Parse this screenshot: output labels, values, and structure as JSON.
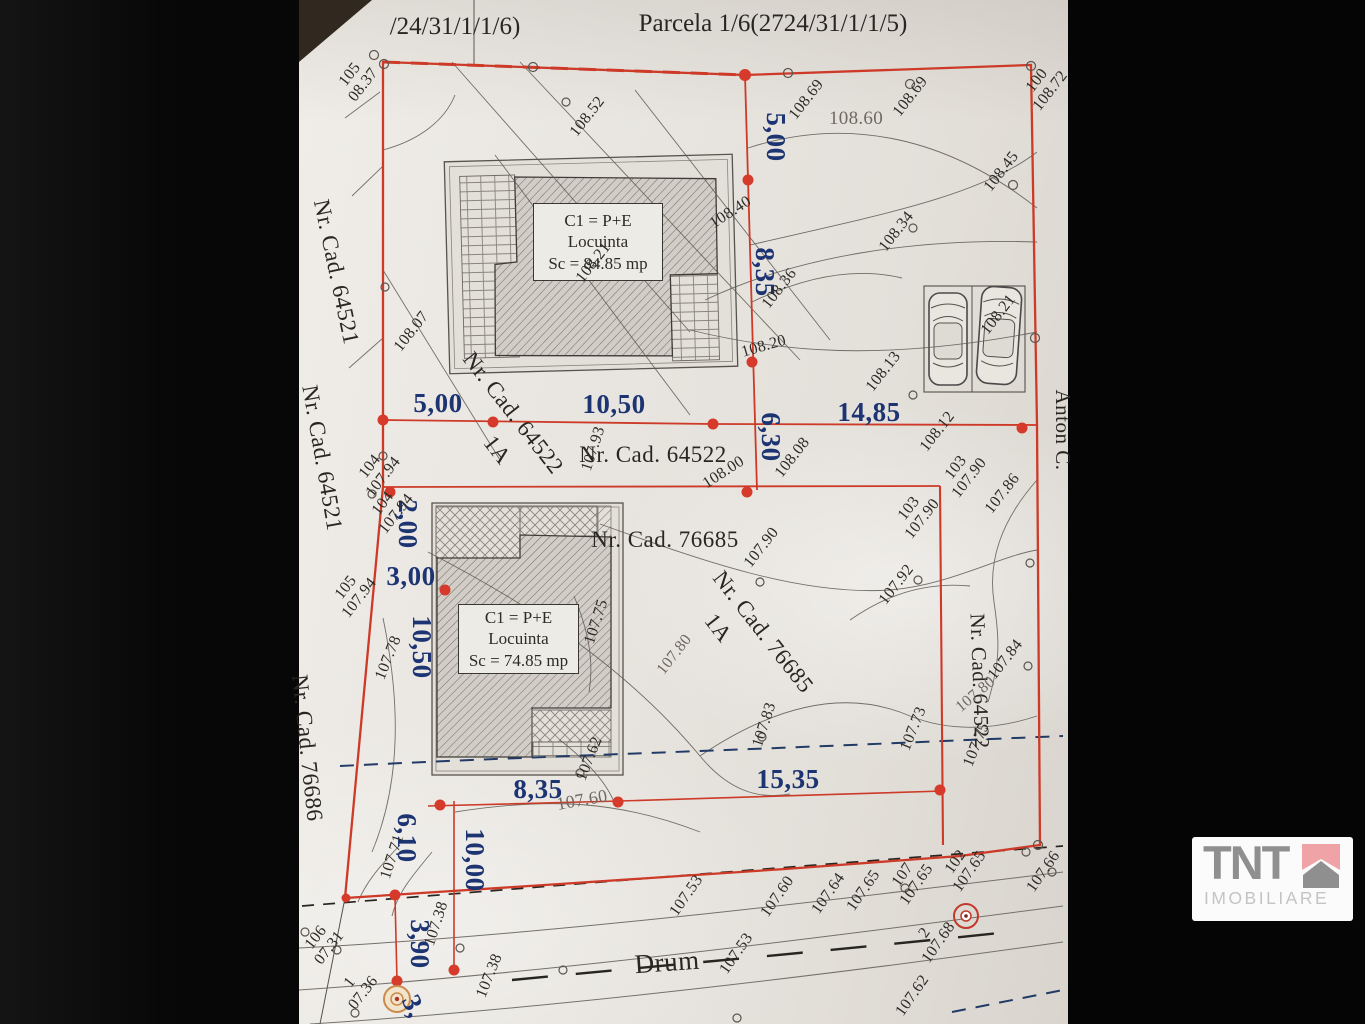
{
  "labels": {
    "header_left": "/24/31/1/1/6)",
    "header_right": "Parcela 1/6(2724/31/1/1/5)",
    "cadastral": [
      "Nr. Cad. 64521",
      "Nr. Cad. 64521",
      "Nr. Cad. 76686",
      "Nr. Cad. 64522",
      "1A",
      "Nr. Cad. 64522",
      "Nr. Cad. 76685",
      "Nr. Cad. 76685",
      "1A",
      "Nr. Cad. 64522",
      "Anton C.",
      "Drum"
    ]
  },
  "dims": [
    "5,00",
    "8,35",
    "6,30",
    "5,00",
    "10,50",
    "14,85",
    "2,00",
    "3,00",
    "10,50",
    "8,35",
    "15,35",
    "6,10",
    "10,00",
    "3,90",
    "3,"
  ],
  "elev": [
    "105\n08.37",
    "108.52",
    "108.69",
    "108.60",
    "108.69",
    "100\n108.72",
    "108.45",
    "108.40",
    "108.34",
    "108.21",
    "108.36",
    "108.21",
    "108.07",
    "108.20",
    "108.13",
    "107.93",
    "108.00",
    "108.08",
    "108.12",
    "103\n107.90",
    "104\n107.94",
    "104\n107.94",
    "103\n107.90",
    "107.86",
    "107.90",
    "105\n107.94",
    "107.92",
    "107.75",
    "107.80",
    "107.78",
    "107.84",
    "107.80",
    "107.73",
    "107.75",
    "107.83",
    "107.62",
    "107.60",
    "107.71",
    "107.38",
    "107.38",
    "106\n07.31",
    "1\n07.36",
    "107.53",
    "107.60",
    "107.64",
    "107.65",
    "107\n107.65",
    "102\n107.65",
    "107.66",
    "2\n107.68",
    "107.53",
    "107.62"
  ],
  "buildings": [
    {
      "line1": "C1 = P+E",
      "line2": "Locuinta",
      "line3": "Sc = 84.85 mp"
    },
    {
      "line1": "C1 = P+E",
      "line2": "Locuinta",
      "line3": "Sc = 74.85 mp"
    }
  ],
  "logo": {
    "name": "TNT",
    "subtitle": "IMOBILIARE"
  },
  "symbols": {
    "benchmark": "survey-benchmark-target",
    "cars": "two-parked-cars-top-view"
  },
  "colors": {
    "boundary_red": "#cd3a28",
    "dimension_blue": "#1d3472",
    "paper": "#e9e6e1",
    "logo_roof_pink": "#f0a3a6",
    "logo_gray": "#8f8f8f"
  }
}
